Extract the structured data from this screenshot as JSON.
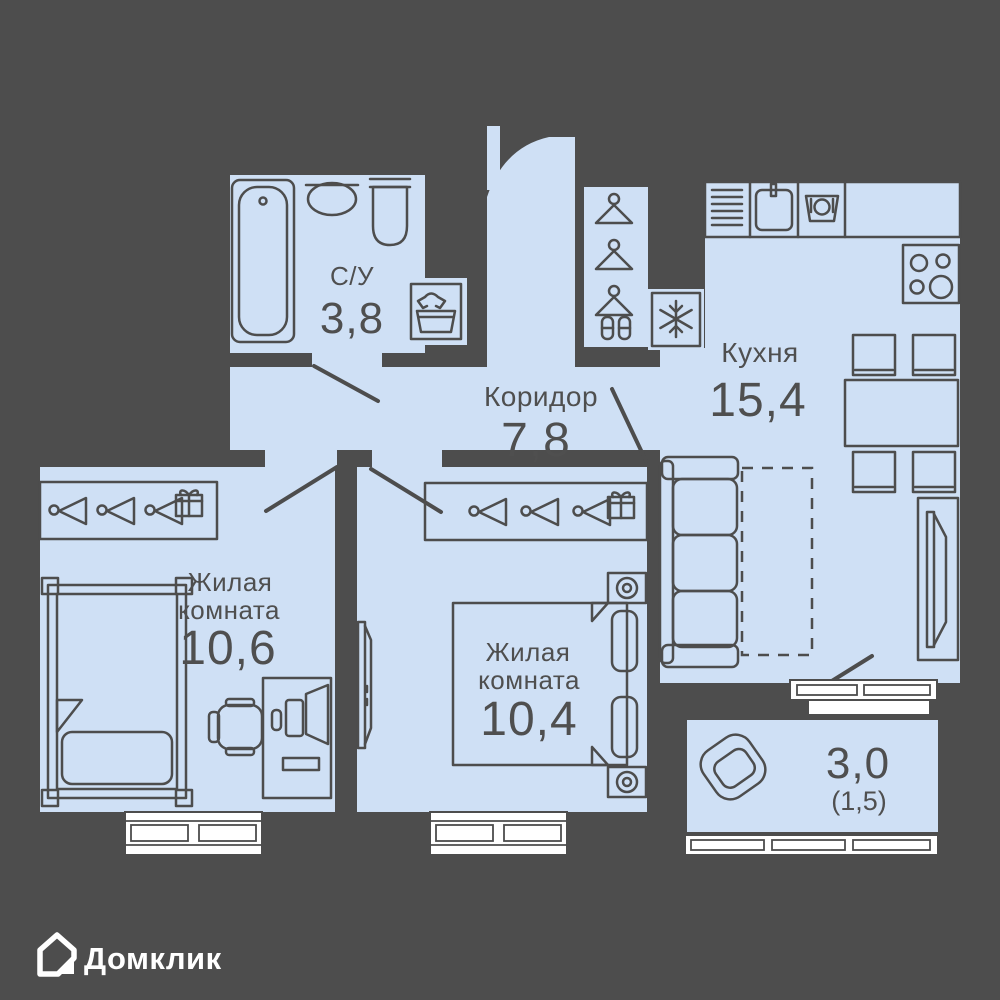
{
  "plan": {
    "rooms": [
      {
        "id": "bathroom",
        "label": "С/У",
        "area": "3,8"
      },
      {
        "id": "corridor",
        "label": "Коридор",
        "area": "7,8"
      },
      {
        "id": "kitchen",
        "label": "Кухня",
        "area": "15,4"
      },
      {
        "id": "living-room-1",
        "label_line1": "Жилая",
        "label_line2": "комната",
        "area": "10,6"
      },
      {
        "id": "living-room-2",
        "label_line1": "Жилая",
        "label_line2": "комната",
        "area": "10,4"
      },
      {
        "id": "balcony",
        "area": "3,0",
        "area_secondary": "(1,5)"
      }
    ],
    "colors": {
      "background": "#4d4d4d",
      "walls": "#4d4d4d",
      "room_fill": "#cfe0f5",
      "label_text": "#4f4f4f",
      "window": "#ffffff",
      "logo": "#ffffff"
    },
    "icons": {
      "bathroom": [
        "bathtub-icon",
        "sink-icon",
        "toilet-icon",
        "washing-machine-icon"
      ],
      "hallway": [
        "hanger-icon",
        "shoes-icon",
        "fridge-icon"
      ],
      "kitchen": [
        "kitchen-sink-icon",
        "dishwasher-icon",
        "stove-icon",
        "dining-table",
        "chair",
        "sofa",
        "sofa-unfold-dashed",
        "tv-icon"
      ],
      "living_rooms": [
        "hanger-icon",
        "gift-icon",
        "single-bed",
        "double-bed",
        "nightstand-lamp-icon",
        "desk",
        "laptop-icon",
        "office-chair",
        "tv-icon"
      ],
      "balcony": [
        "armchair-icon"
      ],
      "branding": [
        "house-icon"
      ]
    }
  },
  "branding": {
    "logo_text": "Домклик"
  }
}
